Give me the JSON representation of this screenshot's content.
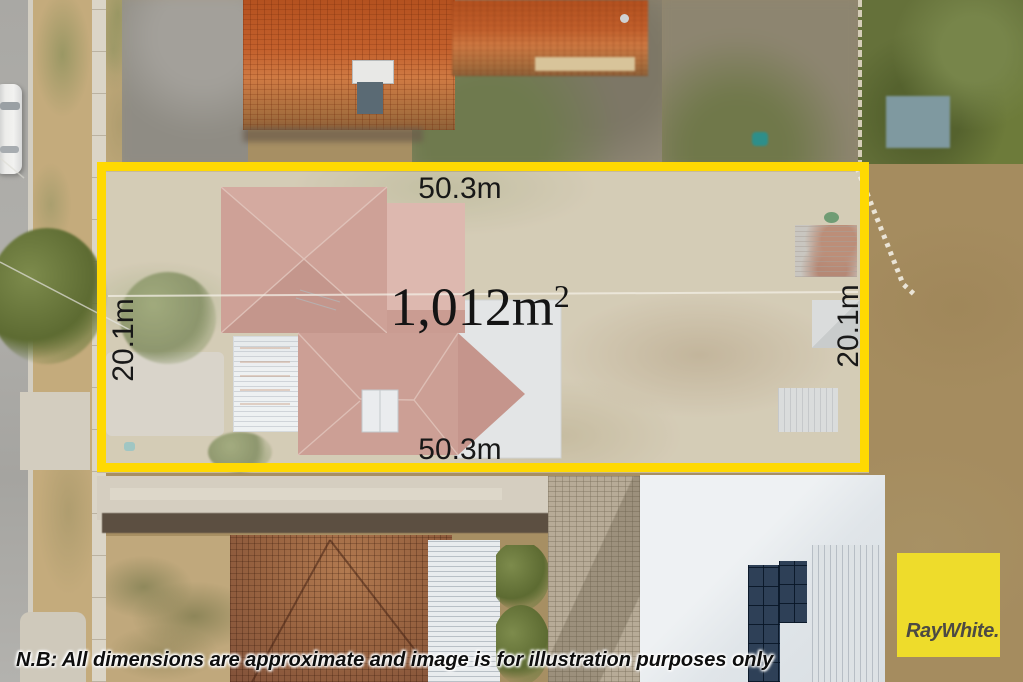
{
  "overlay": {
    "width_top_label": "50.3m",
    "width_bottom_label": "50.3m",
    "depth_left_label": "20.1m",
    "depth_right_label": "20.1m",
    "area_value": "1,012m",
    "area_superscript": "2",
    "boundary_color": "#ffd902",
    "label_color": "#181818"
  },
  "branding": {
    "logo_text": "RayWhite.",
    "logo_background": "#eedc2b",
    "logo_text_color": "#4c4a44"
  },
  "disclaimer_text": "N.B: All dimensions are approximate and image is for illustration purposes only"
}
